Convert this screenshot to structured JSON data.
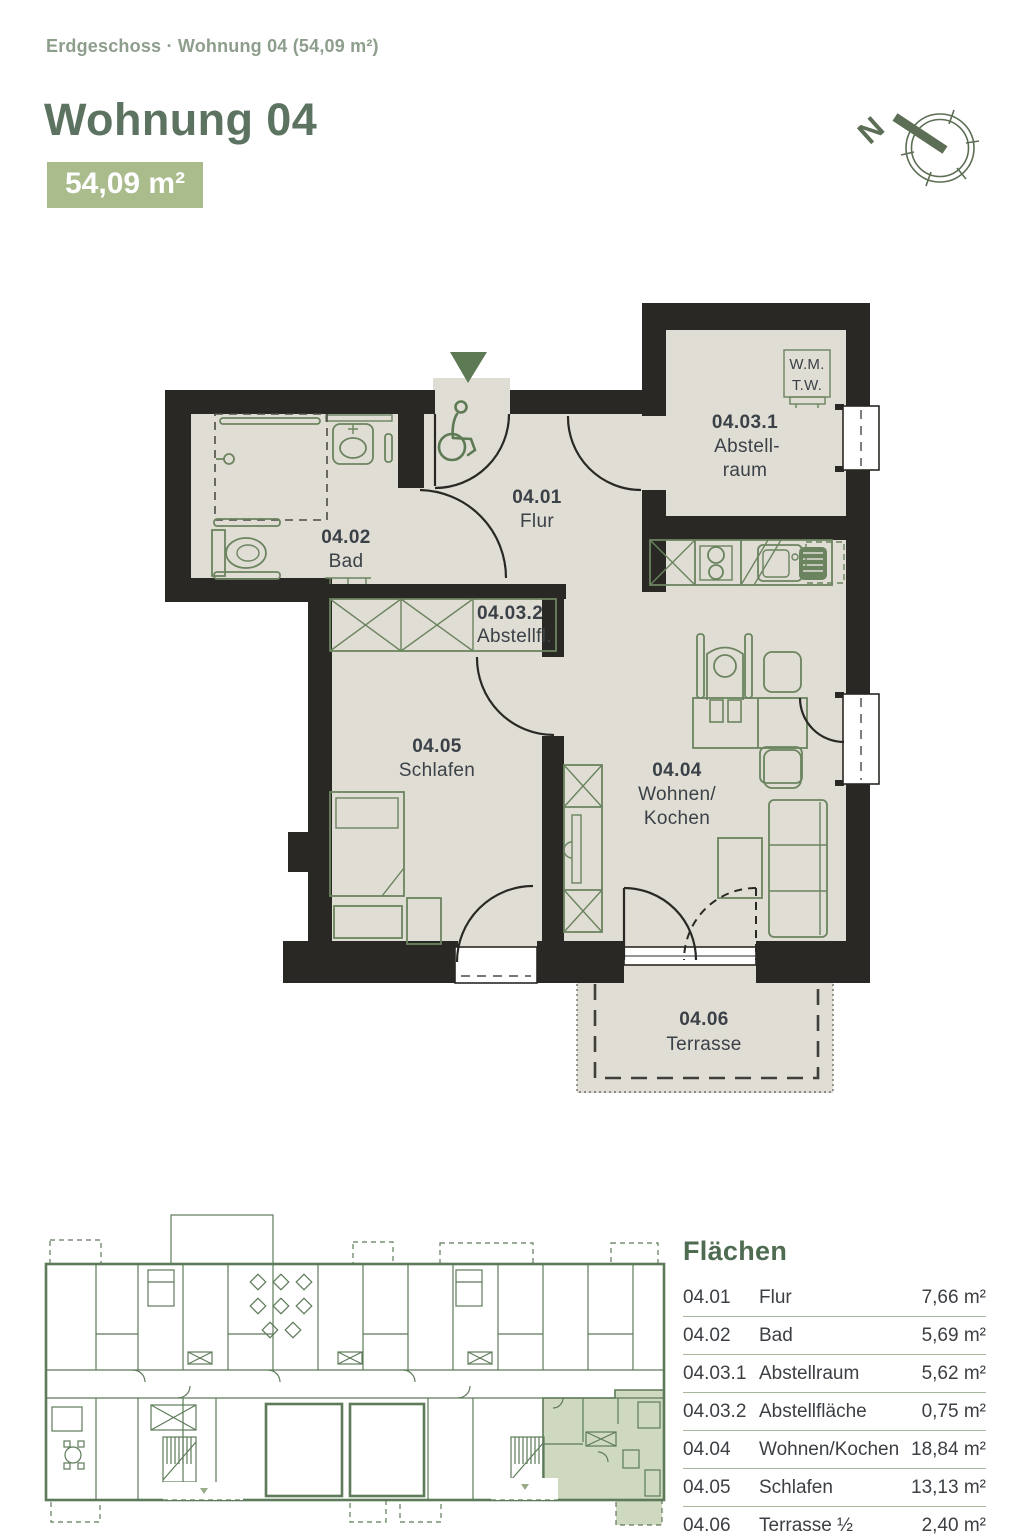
{
  "header": {
    "breadcrumb": "Erdgeschoss · Wohnung 04 (54,09 m²)",
    "title": "Wohnung 04",
    "area_badge": "54,09 m²"
  },
  "north_indicator": {
    "label": "N"
  },
  "floorplan": {
    "rooms": [
      {
        "id": "04.01",
        "name": "Flur"
      },
      {
        "id": "04.02",
        "name": "Bad"
      },
      {
        "id": "04.03.1",
        "name_line1": "Abstell-",
        "name_line2": "raum"
      },
      {
        "id": "04.03.2",
        "name": "Abstellfl."
      },
      {
        "id": "04.04",
        "name_line1": "Wohnen/",
        "name_line2": "Kochen"
      },
      {
        "id": "04.05",
        "name": "Schlafen"
      },
      {
        "id": "04.06",
        "name": "Terrasse"
      }
    ],
    "appliance_box": {
      "line1": "W.M.",
      "line2": "T.W."
    }
  },
  "areas_table": {
    "title": "Flächen",
    "rows": [
      {
        "id": "04.01",
        "name": "Flur",
        "value": "7,66 m²"
      },
      {
        "id": "04.02",
        "name": "Bad",
        "value": "5,69 m²"
      },
      {
        "id": "04.03.1",
        "name": "Abstellraum",
        "value": "5,62 m²"
      },
      {
        "id": "04.03.2",
        "name": "Abstellfläche",
        "value": "0,75 m²"
      },
      {
        "id": "04.04",
        "name": "Wohnen/Kochen",
        "value": "18,84 m²"
      },
      {
        "id": "04.05",
        "name": "Schlafen",
        "value": "13,13 m²"
      },
      {
        "id": "04.06",
        "name": "Terrasse ½",
        "value": "2,40 m²"
      }
    ]
  },
  "colors": {
    "accent_green": "#aabb8c",
    "heading_green": "#5d7361",
    "breadcrumb_green": "#8e9e8c",
    "wall_black": "#2a2824",
    "floor_beige": "#e0ddd5",
    "furniture_green": "#6b845f",
    "overview_green": "#5d7a59",
    "highlight_fill": "#cfd9c0"
  }
}
